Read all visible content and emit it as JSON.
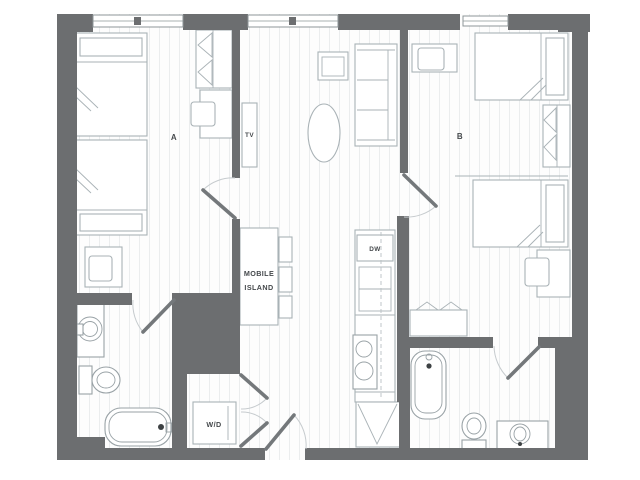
{
  "type": "apartment-floor-plan",
  "labels": {
    "room_a": "A",
    "room_b": "B",
    "tv": "TV",
    "island_line1": "MOBILE",
    "island_line2": "ISLAND",
    "dishwasher": "DW",
    "washer_dryer": "W/D"
  },
  "colors": {
    "wall": "#6c6e70",
    "furniture-line": "#a9b2b6",
    "fixture-line": "#99a2a6",
    "door": "#74787b",
    "arc": "#c6cbce",
    "floor": "#fdfdfd",
    "floor-line": "#ebedee",
    "label": "#45494c",
    "window-line": "#8e9699",
    "dark-dot": "#3d4143",
    "bg": "#ffffff"
  },
  "rooms": [
    {
      "id": "bedroom-a",
      "label": "A",
      "fixtures": [
        "bed",
        "bed",
        "desk-with-chair",
        "desk-with-chair",
        "wardrobe"
      ]
    },
    {
      "id": "bedroom-b",
      "label": "B",
      "fixtures": [
        "bed",
        "bed",
        "desk-with-chair",
        "desk-with-chair",
        "wardrobe",
        "dresser"
      ]
    },
    {
      "id": "living-area",
      "fixtures": [
        "sofa",
        "armchair",
        "coffee-table",
        "tv-console",
        "mobile-island",
        "stool",
        "stool",
        "stool"
      ]
    },
    {
      "id": "kitchen",
      "fixtures": [
        "dishwasher",
        "cabinets",
        "sink",
        "refrigerator"
      ]
    },
    {
      "id": "bathroom-1",
      "fixtures": [
        "vanity-sink",
        "toilet",
        "bathtub"
      ]
    },
    {
      "id": "bathroom-2",
      "fixtures": [
        "bathtub",
        "toilet",
        "vanity-sink"
      ]
    },
    {
      "id": "laundry-closet",
      "fixtures": [
        "washer-dryer"
      ]
    }
  ],
  "openings": {
    "windows": 3,
    "doors": [
      "bedroom-a-door",
      "bedroom-b-door",
      "bathroom-1-door",
      "bathroom-2-door",
      "entry-door",
      "laundry-bifold-doors"
    ]
  }
}
